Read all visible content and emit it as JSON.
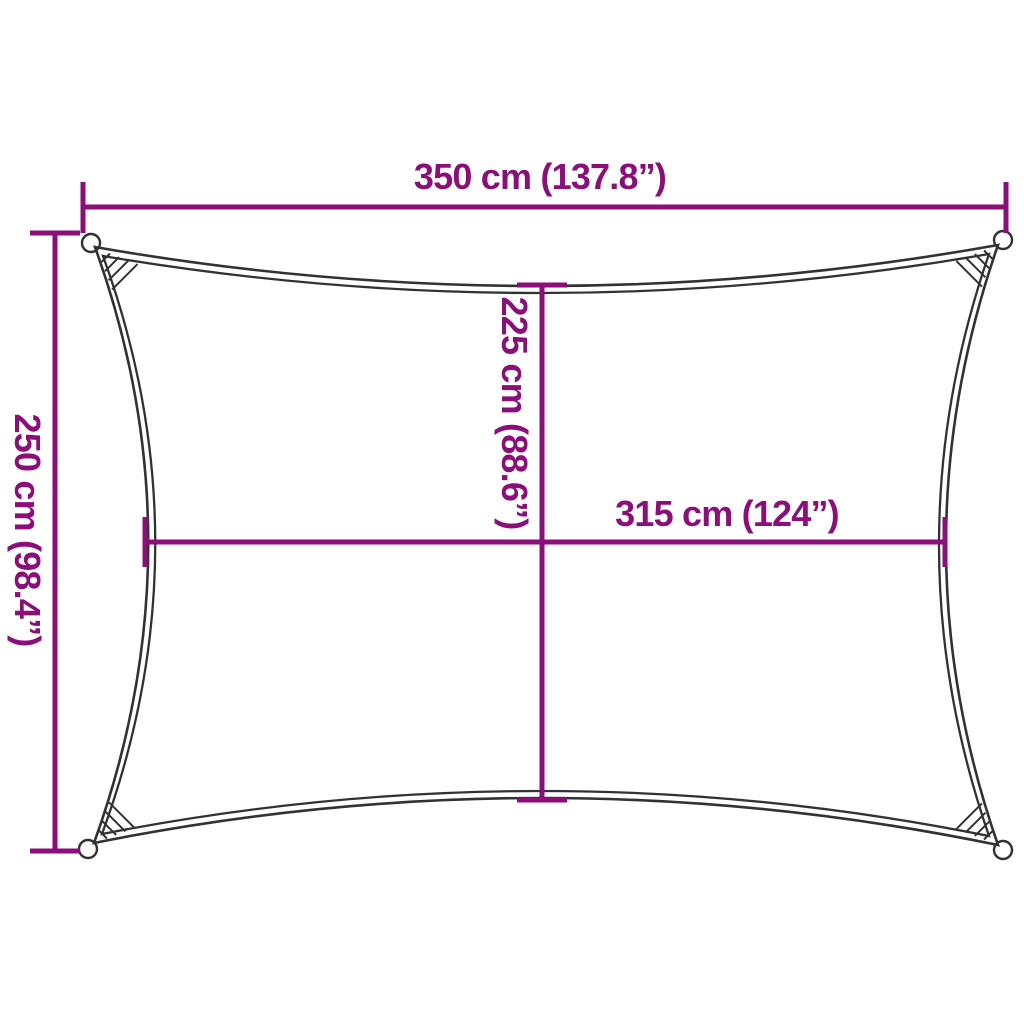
{
  "diagram": {
    "background_color": "#ffffff",
    "accent_color": "#8d0d7b",
    "outline_color": "#323232",
    "dimensions": {
      "outer_width": {
        "cm": "350 cm",
        "inches": "137.8”",
        "label": "350 cm (137.8”)"
      },
      "outer_height": {
        "cm": "250 cm",
        "inches": "98.4”",
        "label": "250 cm (98.4”)"
      },
      "inner_height": {
        "cm": "225 cm",
        "inches": "88.6”",
        "label": "225 cm (88.6”)"
      },
      "inner_width": {
        "cm": "315 cm",
        "inches": "124”",
        "label": "315 cm (124”)"
      }
    }
  }
}
